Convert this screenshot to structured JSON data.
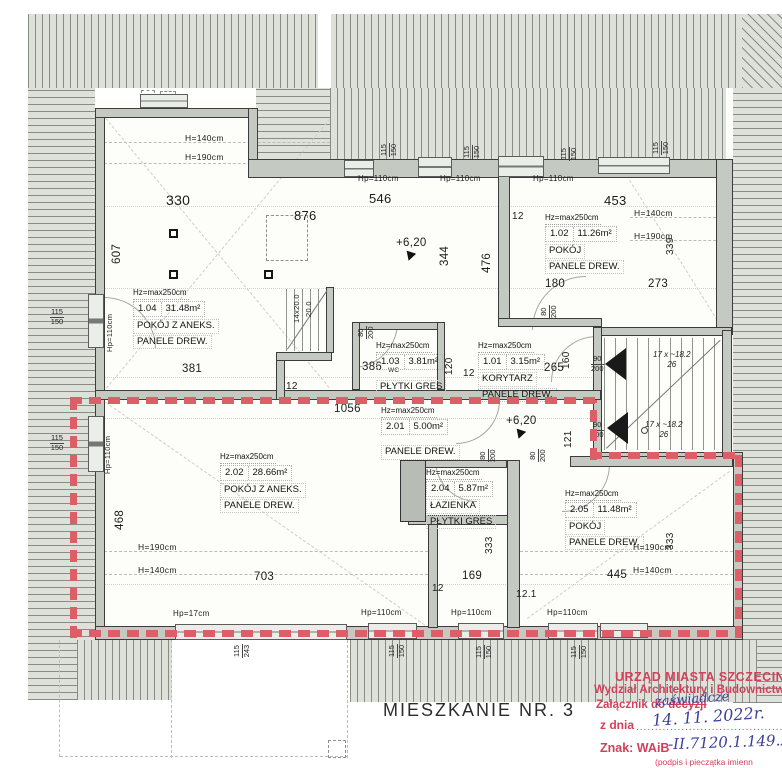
{
  "title": "MIESZKANIE NR. 3",
  "boundary_color": "#dc5f68",
  "rooms": [
    {
      "num": "1.04",
      "hz": "Hz=max250cm",
      "area": "31.48m²",
      "name": "POKÓJ Z ANEKS.",
      "floor": "PANELE DREW.",
      "x": 133,
      "y": 288,
      "gap": false
    },
    {
      "num": "1.02",
      "hz": "Hz=max250cm",
      "area": "11.26m²",
      "name": "POKÓJ",
      "floor": "PANELE DREW.",
      "x": 545,
      "y": 213,
      "gap": false
    },
    {
      "num": "1.03",
      "hz": "Hz=max250cm",
      "area": "3.81m²",
      "name": "",
      "floor": "PŁYTKI GRES",
      "x": 376,
      "y": 341,
      "gap": true
    },
    {
      "num": "1.01",
      "hz": "Hz=max250cm",
      "area": "3.15m²",
      "name": "KORYTARZ",
      "floor": "PANELE DREW.",
      "x": 478,
      "y": 341,
      "gap": false
    },
    {
      "num": "2.01",
      "hz": "Hz=max250cm",
      "area": "5.00m²",
      "name": "",
      "floor": "PANELE DREW.",
      "x": 381,
      "y": 406,
      "gap": true
    },
    {
      "num": "2.02",
      "hz": "Hz=max250cm",
      "area": "28.66m²",
      "name": "POKÓJ Z ANEKS.",
      "floor": "PANELE DREW.",
      "x": 220,
      "y": 452,
      "gap": false
    },
    {
      "num": "2.04",
      "hz": "Hz=max250cm",
      "area": "5.87m²",
      "name": "ŁAZIENKA",
      "floor": "PŁYTKI GRES",
      "x": 426,
      "y": 468,
      "gap": false
    },
    {
      "num": "2.05",
      "hz": "Hz=max250cm",
      "area": "11.48m²",
      "name": "POKÓJ",
      "floor": "PANELE DREW.",
      "x": 565,
      "y": 489,
      "gap": false
    }
  ],
  "dims": [
    {
      "t": "330",
      "x": 166,
      "y": 193,
      "fs": 14
    },
    {
      "t": "546",
      "x": 369,
      "y": 192,
      "fs": 13
    },
    {
      "t": "876",
      "x": 294,
      "y": 209,
      "fs": 13
    },
    {
      "t": "453",
      "x": 604,
      "y": 194,
      "fs": 13
    },
    {
      "t": "12",
      "x": 512,
      "y": 212,
      "fs": 10
    },
    {
      "t": "180",
      "x": 545,
      "y": 279,
      "fs": 11.5
    },
    {
      "t": "273",
      "x": 648,
      "y": 279,
      "fs": 11.5
    },
    {
      "t": "381",
      "x": 182,
      "y": 364,
      "fs": 11.5
    },
    {
      "t": "12",
      "x": 286,
      "y": 382,
      "fs": 10
    },
    {
      "t": "386",
      "x": 362,
      "y": 362,
      "fs": 11.5
    },
    {
      "t": "WC",
      "x": 388,
      "y": 368,
      "fs": 6.5
    },
    {
      "t": "265",
      "x": 544,
      "y": 363,
      "fs": 11.5
    },
    {
      "t": "12",
      "x": 463,
      "y": 369,
      "fs": 10
    },
    {
      "t": "1056",
      "x": 334,
      "y": 404,
      "fs": 11.5
    },
    {
      "t": "703",
      "x": 254,
      "y": 572,
      "fs": 11.5
    },
    {
      "t": "169",
      "x": 462,
      "y": 571,
      "fs": 11.5
    },
    {
      "t": "445",
      "x": 607,
      "y": 570,
      "fs": 11.5
    },
    {
      "t": "12",
      "x": 432,
      "y": 584,
      "fs": 10
    },
    {
      "t": "12.1",
      "x": 516,
      "y": 590,
      "fs": 10
    },
    {
      "t": "H=140cm",
      "x": 185,
      "y": 134,
      "fs": 8.5
    },
    {
      "t": "H=190cm",
      "x": 185,
      "y": 153,
      "fs": 8.5
    },
    {
      "t": "H=140cm",
      "x": 634,
      "y": 209,
      "fs": 8.5
    },
    {
      "t": "H=190cm",
      "x": 634,
      "y": 232,
      "fs": 8.5
    },
    {
      "t": "H=190cm",
      "x": 138,
      "y": 543,
      "fs": 8.5
    },
    {
      "t": "H=140cm",
      "x": 138,
      "y": 566,
      "fs": 8.5
    },
    {
      "t": "H=190cm",
      "x": 633,
      "y": 543,
      "fs": 8.5
    },
    {
      "t": "H=140cm",
      "x": 633,
      "y": 566,
      "fs": 8.5
    },
    {
      "t": "Hp=110cm",
      "x": 358,
      "y": 175,
      "fs": 8
    },
    {
      "t": "Hp=110cm",
      "x": 440,
      "y": 175,
      "fs": 8
    },
    {
      "t": "Hp=110cm",
      "x": 533,
      "y": 175,
      "fs": 8
    },
    {
      "t": "Hp=17cm",
      "x": 173,
      "y": 610,
      "fs": 8
    },
    {
      "t": "Hp=110cm",
      "x": 361,
      "y": 609,
      "fs": 8
    },
    {
      "t": "Hp=110cm",
      "x": 451,
      "y": 609,
      "fs": 8
    },
    {
      "t": "Hp=110cm",
      "x": 547,
      "y": 609,
      "fs": 8
    },
    {
      "t": "607",
      "x": 112,
      "y": 264,
      "r": -90,
      "fs": 11.5
    },
    {
      "t": "344",
      "x": 440,
      "y": 266,
      "r": -90,
      "fs": 11.5
    },
    {
      "t": "476",
      "x": 482,
      "y": 273,
      "r": -90,
      "fs": 11.5
    },
    {
      "t": "120",
      "x": 445,
      "y": 375,
      "r": -90,
      "fs": 10
    },
    {
      "t": "160",
      "x": 562,
      "y": 369,
      "r": -90,
      "fs": 10
    },
    {
      "t": "121",
      "x": 564,
      "y": 448,
      "r": -90,
      "fs": 10
    },
    {
      "t": "468",
      "x": 115,
      "y": 530,
      "r": -90,
      "fs": 11.5
    },
    {
      "t": "333",
      "x": 485,
      "y": 554,
      "r": -90,
      "fs": 10
    },
    {
      "t": "333",
      "x": 666,
      "y": 550,
      "r": -90,
      "fs": 10
    },
    {
      "t": "339",
      "x": 666,
      "y": 255,
      "r": -90,
      "fs": 10
    },
    {
      "t": "Hp=110cm",
      "x": 106,
      "y": 352,
      "r": -90,
      "fs": 7.5
    },
    {
      "t": "Hp=110cm",
      "x": 104,
      "y": 474,
      "r": -90,
      "fs": 7.5
    },
    {
      "t": "14x20.0",
      "x": 293,
      "y": 323,
      "r": -90,
      "fs": 7.5
    },
    {
      "t": "20.0",
      "x": 305,
      "y": 317,
      "r": -90,
      "fs": 7.5
    }
  ],
  "fractions": [
    {
      "a": "115",
      "b": "150",
      "x": 50,
      "y": 308
    },
    {
      "a": "115",
      "b": "150",
      "x": 50,
      "y": 434
    },
    {
      "a": "115",
      "b": "150",
      "x": 380,
      "y": 157,
      "r": -90
    },
    {
      "a": "115",
      "b": "150",
      "x": 463,
      "y": 159,
      "r": -90
    },
    {
      "a": "115",
      "b": "150",
      "x": 560,
      "y": 161,
      "r": -90
    },
    {
      "a": "115",
      "b": "150",
      "x": 652,
      "y": 155,
      "r": -90
    },
    {
      "a": "115",
      "b": "243",
      "x": 233,
      "y": 658,
      "r": -90
    },
    {
      "a": "115",
      "b": "150",
      "x": 388,
      "y": 658,
      "r": -90
    },
    {
      "a": "115",
      "b": "150",
      "x": 475,
      "y": 659,
      "r": -90
    },
    {
      "a": "115",
      "b": "150",
      "x": 570,
      "y": 659,
      "r": -90
    },
    {
      "a": "80",
      "b": "200",
      "x": 357,
      "y": 339,
      "r": -90
    },
    {
      "a": "80",
      "b": "200",
      "x": 540,
      "y": 318,
      "r": -90
    },
    {
      "a": "80",
      "b": "200",
      "x": 479,
      "y": 462,
      "r": -90
    },
    {
      "a": "80",
      "b": "200",
      "x": 529,
      "y": 462,
      "r": -90
    },
    {
      "a": "90",
      "b": "200",
      "x": 591,
      "y": 355
    },
    {
      "a": "90",
      "b": "200",
      "x": 591,
      "y": 421
    }
  ],
  "stair_labels": [
    {
      "l1": "17 x ~18.2",
      "l2": "26",
      "x": 653,
      "y": 350
    },
    {
      "l1": "17 x ~18.2",
      "l2": "26",
      "x": 645,
      "y": 420
    }
  ],
  "level_marks": [
    {
      "t": "+6,20",
      "x": 396,
      "y": 238
    },
    {
      "t": "+6,20",
      "x": 506,
      "y": 416
    }
  ],
  "stamp": {
    "office": "URZĄD MIASTA SZCZECIN",
    "department": "Wydział Architektury i Budownictwa",
    "attachment_prefix": "Załącznik do ",
    "attachment_struck": "decyzji",
    "attachment_handwritten": "zaświadcze",
    "date_label": "z dnia",
    "date_dots": "..........................................",
    "date_handwritten": "14. 11. 2022r.",
    "ref_label": "Znak: WAiB",
    "ref_handwritten": "-II.7120.1.149.20",
    "signature_note": "(podpis i pieczątka imienn",
    "stamp_color": "#d2405a",
    "ink_color": "#3c3f9c"
  }
}
